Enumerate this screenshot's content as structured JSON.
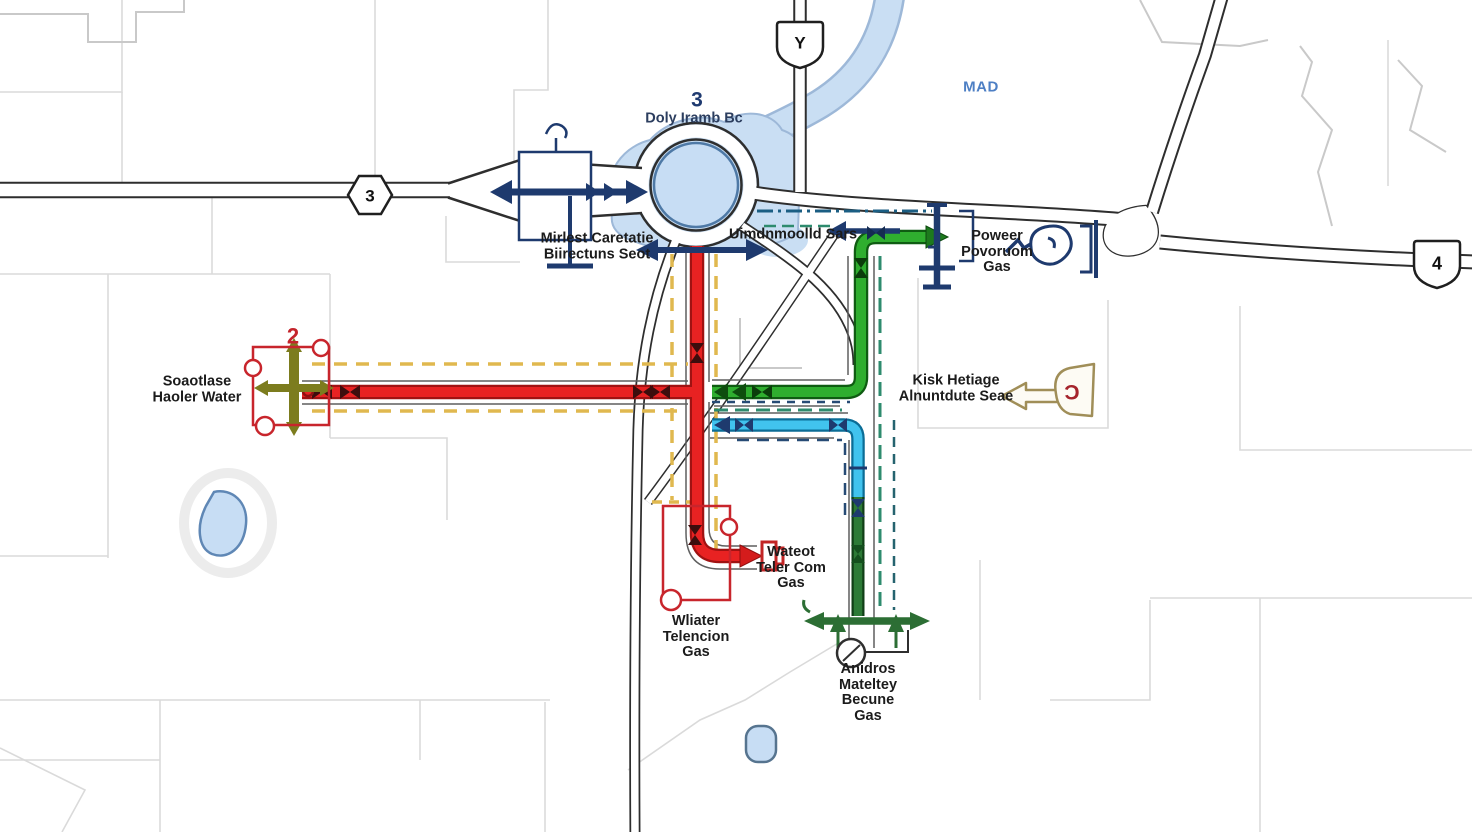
{
  "shields": {
    "route3": "3",
    "routeY": "Y",
    "route4": "4"
  },
  "callouts": {
    "junction_number": "3",
    "water_number": "2"
  },
  "labels": {
    "junction_name": "Doly Iramb Bc",
    "area": "MAD",
    "west_station": {
      "lines": [
        "Mirlest Caretatie",
        "Biirectuns Seot"
      ]
    },
    "sars": "Uimdnmoolld Sars",
    "power": {
      "lines": [
        "Poweer",
        "Povoruom",
        "Gas"
      ]
    },
    "water_left": {
      "lines": [
        "Soaotlase",
        "Haoler Water"
      ]
    },
    "heritage": {
      "lines": [
        "Kisk Hetiage",
        "Alnuntdute Seae"
      ]
    },
    "telecom": {
      "lines": [
        "Wateot",
        "Teler Com",
        "Gas"
      ]
    },
    "water_telecom": {
      "lines": [
        "Wliater",
        "Telencion",
        "Gas"
      ]
    },
    "gas_meter": {
      "lines": [
        "Anidros",
        "Mateltey",
        "Becune",
        "Gas"
      ]
    }
  },
  "icons": {
    "heritage_glyph": "Ɔ",
    "valve_cross": "olive-cross-valve",
    "hydrant": "navy-hydrant",
    "heritage_marker": "tan-left-arrow-flask"
  },
  "colors": {
    "water_main": "#e82222",
    "gas_main": "#2fae2f",
    "telecom_main": "#41c3ee",
    "gas_service": "#2c7a36",
    "power_navy": "#1e3a6e",
    "survey_dashed": "#e0b84f",
    "river": "#c9def3"
  }
}
